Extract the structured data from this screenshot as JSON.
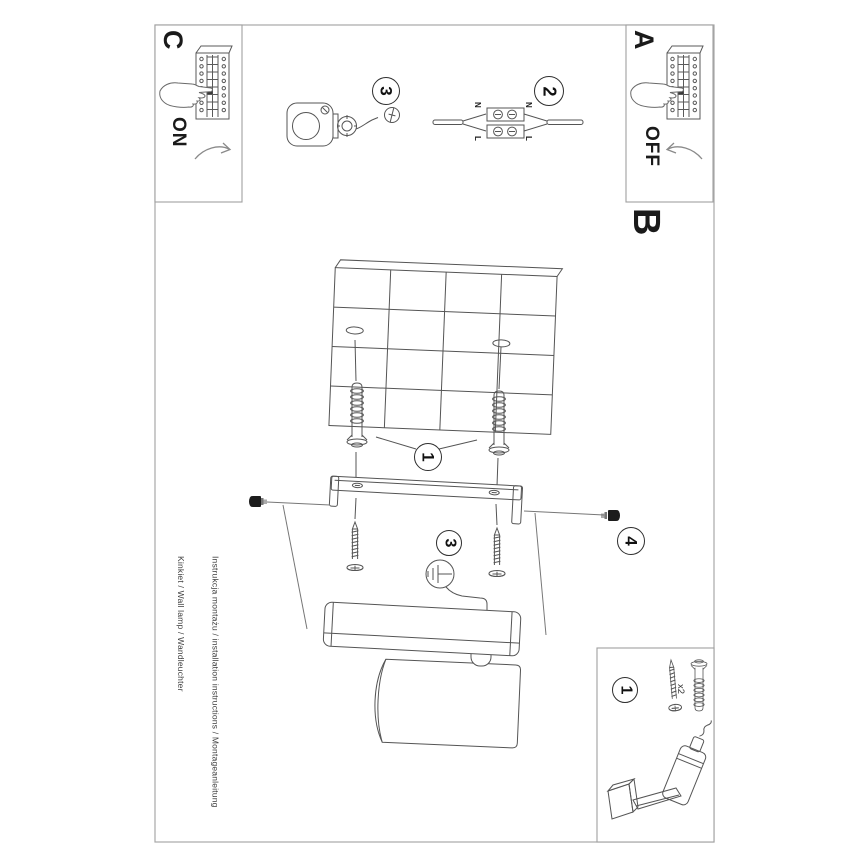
{
  "document": {
    "type": "installation-instruction-sheet",
    "orientation": "rotated-90-clockwise"
  },
  "panel_c": {
    "letter": "C",
    "state_label": "ON"
  },
  "panel_a": {
    "letter": "A",
    "state_label": "OFF"
  },
  "section_b": {
    "letter": "B"
  },
  "steps": {
    "one": "1",
    "two": "2",
    "three": "3",
    "four": "4"
  },
  "wiring": {
    "n_left": "N",
    "n_right": "N",
    "l_left": "L",
    "l_right": "L"
  },
  "parts_box": {
    "step": "1",
    "qty_label": "x2"
  },
  "footer": {
    "line1": "Instrukcja montażu / installation instructions / Montageanleitung",
    "line2": "Kinkiet / Wall lamp / Wandleuchter"
  },
  "colors": {
    "line": "#555555",
    "frame": "#9a9a9a",
    "text": "#1a1a1a"
  }
}
